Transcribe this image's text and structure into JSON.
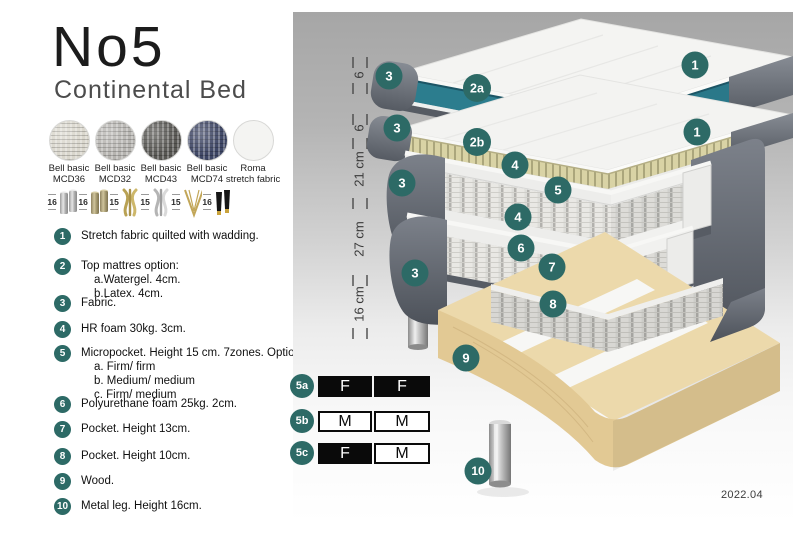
{
  "header": {
    "title": "No5",
    "subtitle": "Continental Bed"
  },
  "fabrics": {
    "items": [
      {
        "line1": "Bell basic",
        "line2": "MCD36",
        "color": "#d9d6cc"
      },
      {
        "line1": "Bell basic",
        "line2": "MCD32",
        "color": "#b5b3af"
      },
      {
        "line1": "Bell basic",
        "line2": "MCD43",
        "color": "#585753"
      },
      {
        "line1": "Bell basic",
        "line2": "MCD74",
        "color": "#3d4564"
      },
      {
        "line1": "Roma",
        "line2": "stretch fabric",
        "color": "#f4f4f2"
      }
    ]
  },
  "legs": {
    "options": [
      {
        "size": "16",
        "type": "cylinder-silver"
      },
      {
        "size": "16",
        "type": "cylinder-bronze"
      },
      {
        "size": "15",
        "type": "twist-gold"
      },
      {
        "size": "15",
        "type": "twist-silver"
      },
      {
        "size": "15",
        "type": "hairpin-gold"
      },
      {
        "size": "16",
        "type": "tapered-black-gold"
      }
    ]
  },
  "list": {
    "items": [
      {
        "num": "1",
        "text": "Stretch fabric quilted with wadding."
      },
      {
        "num": "2",
        "text": "Top mattres option:",
        "sub1": "a.Watergel. 4cm.",
        "sub2": "b.Latex. 4cm."
      },
      {
        "num": "3",
        "text": "Fabric."
      },
      {
        "num": "4",
        "text": "HR foam 30kg. 3cm."
      },
      {
        "num": "5",
        "text": "Micropocket. Height 15 cm. 7zones. Option:",
        "sub1": "a. Firm/ firm",
        "sub2": "b. Medium/ medium",
        "sub3": "c. Firm/ medium"
      },
      {
        "num": "6",
        "text": "Polyurethane foam 25kg. 2cm."
      },
      {
        "num": "7",
        "text": "Pocket. Height 13cm."
      },
      {
        "num": "8",
        "text": "Pocket. Height 10cm."
      },
      {
        "num": "9",
        "text": "Wood."
      },
      {
        "num": "10",
        "text": "Metal leg. Height 16cm."
      }
    ]
  },
  "diagram": {
    "ruler": {
      "labels": [
        "6",
        "6",
        "21 cm",
        "27 cm",
        "16 cm"
      ]
    },
    "callouts": {
      "l1_top": "1",
      "l1_cap": "3",
      "gel": "2a",
      "l2_cap": "3",
      "latex": "2b",
      "l2_top": "1",
      "foam_top": "4",
      "micropocket": "5",
      "l3_cap": "3",
      "foam_bottom": "4",
      "poly_foam": "6",
      "pocket13": "7",
      "l4_cap": "3",
      "pocket10": "8",
      "wood": "9",
      "metal_leg": "10"
    },
    "firmness": {
      "rows": [
        {
          "label": "5a",
          "left": "F",
          "right": "F"
        },
        {
          "label": "5b",
          "left": "M",
          "right": "M"
        },
        {
          "label": "5c",
          "left": "F",
          "right": "M"
        }
      ]
    },
    "colors": {
      "teal_badge": "#2d6a66",
      "watergel": "#2c7d8e",
      "latex": "#d6d0a0",
      "fabric_gray": "#5a5f67",
      "wood": "#e8d3a2"
    },
    "version": "2022.04"
  }
}
